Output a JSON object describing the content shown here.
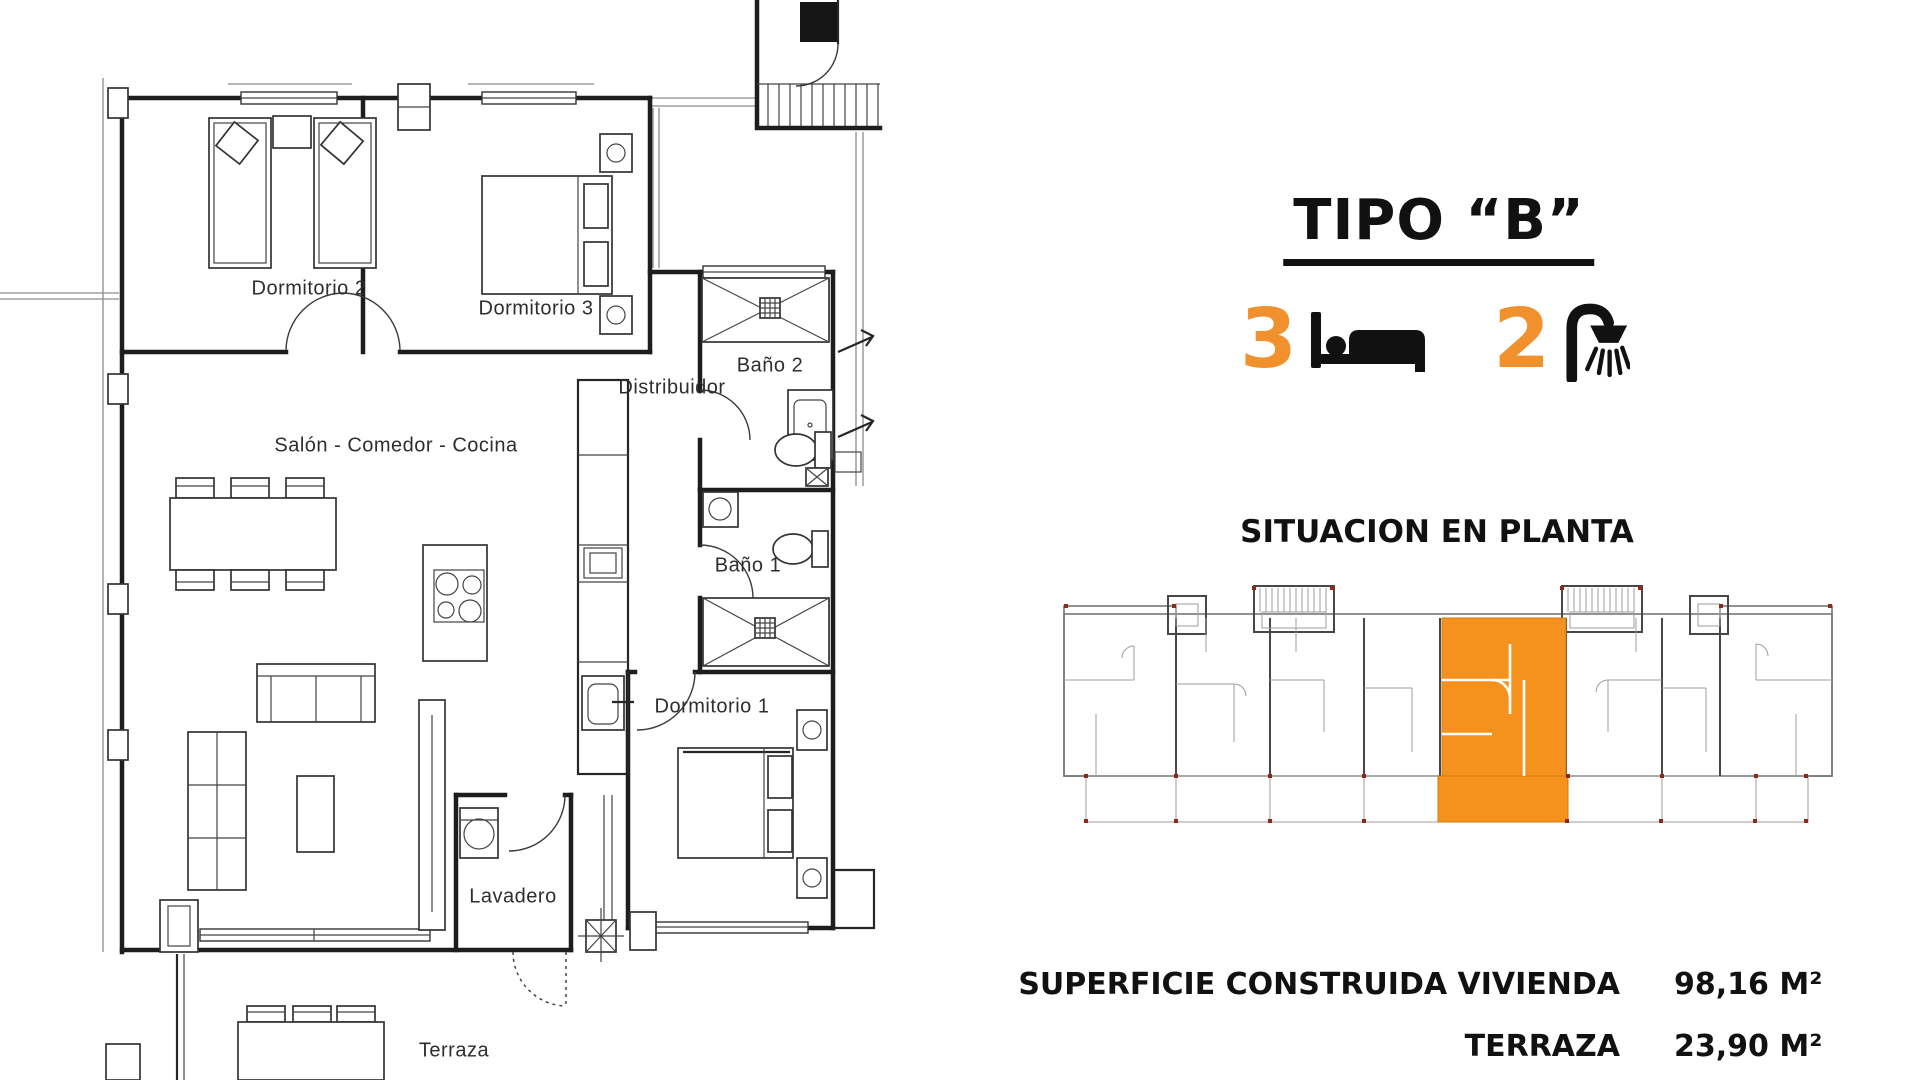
{
  "plan": {
    "labels": {
      "dormitorio2": "Dormitorio 2",
      "dormitorio3": "Dormitorio 3",
      "bano2": "Baño 2",
      "distribuidor": "Distribuidor",
      "salon": "Salón - Comedor - Cocina",
      "bano1": "Baño 1",
      "dormitorio1": "Dormitorio 1",
      "lavadero": "Lavadero",
      "terraza": "Terraza"
    }
  },
  "panel": {
    "title": "TIPO “B”",
    "bedrooms_count": "3",
    "bathrooms_count": "2",
    "situation_title": "SITUACION EN PLANTA",
    "areas": [
      {
        "label": "SUPERFICIE CONSTRUIDA VIVIENDA",
        "value": "98,16 M²"
      },
      {
        "label": "TERRAZA",
        "value": "23,90 M²"
      }
    ]
  },
  "colors": {
    "accent_orange": "#F5921E",
    "number_orange": "#F0912D",
    "line_dark": "#1d1d1d",
    "line_gray": "#6f6f6f"
  }
}
